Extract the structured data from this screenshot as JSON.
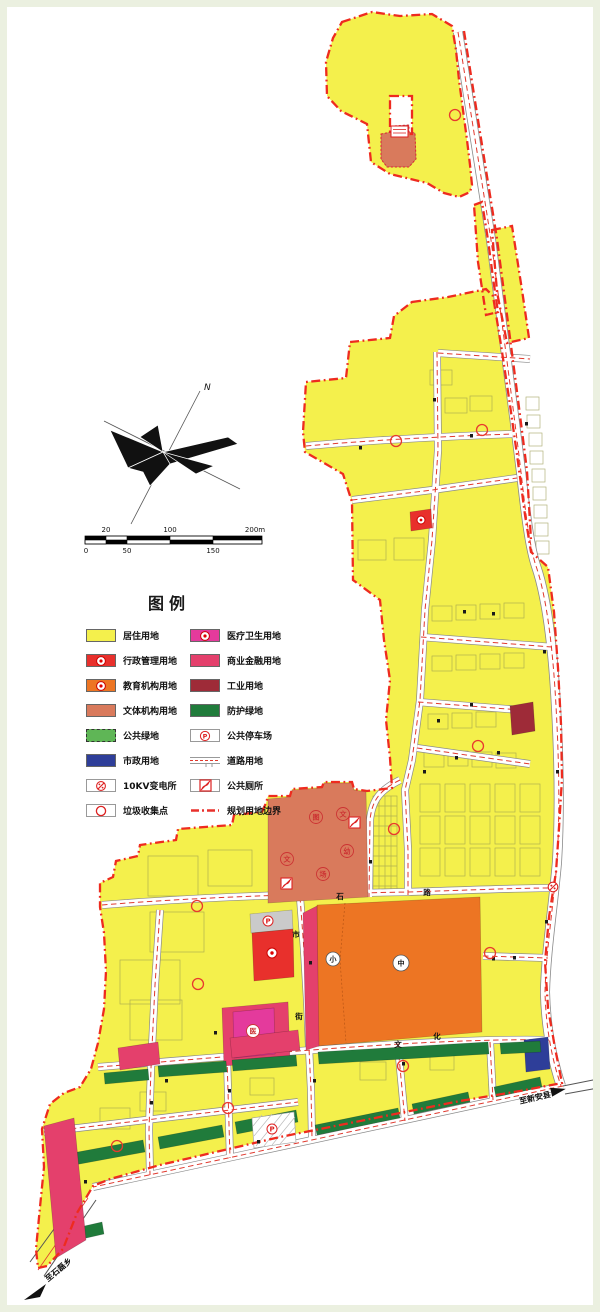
{
  "page": {
    "background": "#ffffff",
    "frame_color": "#ebf0e0"
  },
  "legend": {
    "title": "图例",
    "left": [
      {
        "label": "居住用地",
        "key": "residential"
      },
      {
        "label": "行政管理用地",
        "key": "admin"
      },
      {
        "label": "教育机构用地",
        "key": "education"
      },
      {
        "label": "文体机构用地",
        "key": "culture"
      },
      {
        "label": "公共绿地",
        "key": "public_green"
      },
      {
        "label": "市政用地",
        "key": "municipal"
      },
      {
        "label": "10KV变电所",
        "key": "substation"
      },
      {
        "label": "垃圾收集点",
        "key": "garbage"
      }
    ],
    "right": [
      {
        "label": "医疗卫生用地",
        "key": "medical"
      },
      {
        "label": "商业金融用地",
        "key": "commercial"
      },
      {
        "label": "工业用地",
        "key": "industrial"
      },
      {
        "label": "防护绿地",
        "key": "protective_green"
      },
      {
        "label": "公共停车场",
        "key": "parking"
      },
      {
        "label": "道路用地",
        "key": "road"
      },
      {
        "label": "公共厕所",
        "key": "toilet"
      },
      {
        "label": "规划用地边界",
        "key": "boundary"
      }
    ]
  },
  "colors": {
    "residential": "#F4F04C",
    "admin": "#E8302C",
    "education": "#ED7523",
    "culture": "#D97A5C",
    "public_green": "#5FB656",
    "municipal": "#2E3E99",
    "medical": "#E43A9C",
    "commercial": "#E4406C",
    "industrial": "#9E2B38",
    "protective_green": "#207B3B",
    "parking_gray": "#CACACA",
    "boundary": "#EE2B1F",
    "road_line": "#E0392E"
  },
  "compass": {
    "north_label": "N"
  },
  "scalebar": {
    "top_labels": [
      "20",
      "100",
      "200m"
    ],
    "bottom_labels": [
      "0",
      "50",
      "150"
    ]
  },
  "map_labels": {
    "roads": [
      {
        "text": "石"
      },
      {
        "text": "路"
      },
      {
        "text": "文"
      },
      {
        "text": "化"
      },
      {
        "text": "市"
      },
      {
        "text": "街"
      }
    ],
    "areas": [
      {
        "text": "中"
      },
      {
        "text": "小"
      },
      {
        "text": "医"
      },
      {
        "text": "图"
      },
      {
        "text": "文"
      },
      {
        "text": "幼"
      },
      {
        "text": "场"
      },
      {
        "text": "文"
      }
    ],
    "parking_letter": "P",
    "destinations": [
      {
        "text": "至新安县"
      },
      {
        "text": "至石磊乡"
      }
    ]
  }
}
